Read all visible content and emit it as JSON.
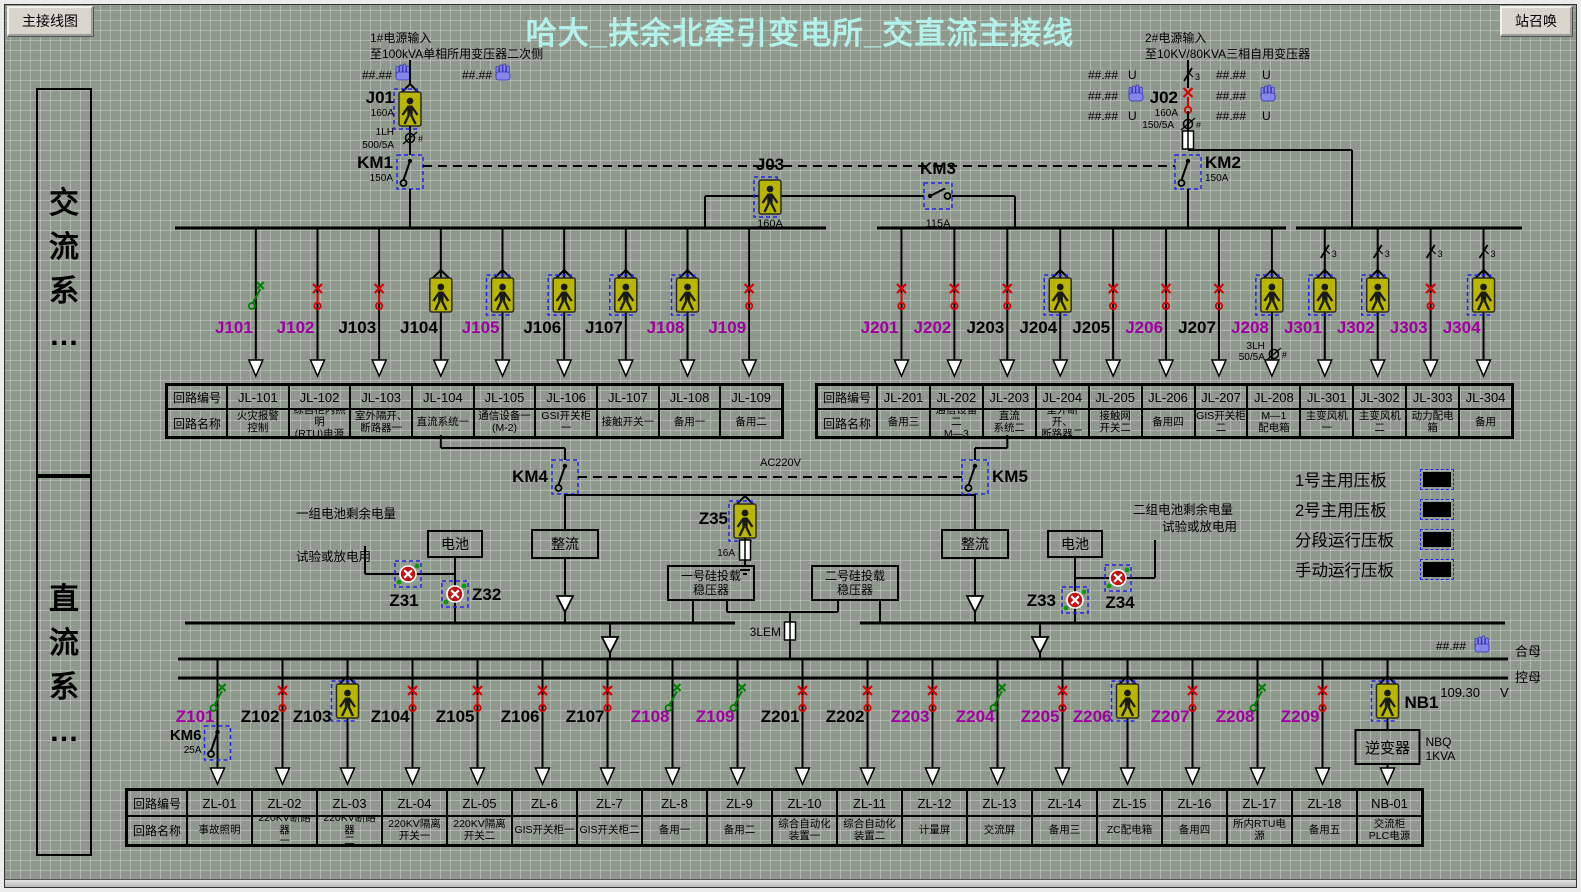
{
  "window": {
    "main_button": "主接线图",
    "call_button": "站召唤",
    "title": "哈大_扶余北牵引变电所_交直流主接线"
  },
  "sidebar": {
    "ac": "交流系…",
    "dc": "直流系…"
  },
  "symbols": {
    "ct_mark": "#"
  },
  "colors": {
    "magenta": "#A000A0",
    "title": "#B2F2EA",
    "yellow": "#B9B600",
    "red": "#D80000",
    "green": "#008000",
    "blue": "#2525E8",
    "bg": "#8F988D"
  },
  "source1": {
    "line1": "1#电源输入",
    "line2": "至100kVA单相所用变压器二次侧",
    "meter_left": "##.##",
    "meter_right": "##.##",
    "breaker": "J01",
    "breaker_rating": "160A",
    "ct_name": "1LH",
    "ct_ratio": "500/5A",
    "contactor": "KM1",
    "contactor_rating": "150A"
  },
  "source2": {
    "line1": "2#电源输入",
    "line2": "至10KV/80KVA三相自用变压器",
    "meters_left": [
      "##.##",
      "##.##",
      "##.##"
    ],
    "meters_right": [
      "##.##",
      "##.##",
      "##.##"
    ],
    "unit": "U",
    "phase": "3",
    "breaker": "J02",
    "breaker_rating": "160A",
    "ct_ratio": "150/5A",
    "contactor": "KM2",
    "contactor_rating": "150A"
  },
  "tie": {
    "breaker": "J03",
    "breaker_rating": "160A",
    "contactor": "KM3",
    "contactor_rating": "115A"
  },
  "ac_left": {
    "feeders": [
      {
        "id": "J101",
        "color": "magenta",
        "symbol": "green-open"
      },
      {
        "id": "J102",
        "color": "magenta",
        "symbol": "red-x"
      },
      {
        "id": "J103",
        "color": "black",
        "symbol": "red-x"
      },
      {
        "id": "J104",
        "color": "black",
        "symbol": "person"
      },
      {
        "id": "J105",
        "color": "magenta",
        "symbol": "person-dash"
      },
      {
        "id": "J106",
        "color": "black",
        "symbol": "person-dash"
      },
      {
        "id": "J107",
        "color": "black",
        "symbol": "person-dash"
      },
      {
        "id": "J108",
        "color": "magenta",
        "symbol": "person-dash"
      },
      {
        "id": "J109",
        "color": "magenta",
        "symbol": "red-x"
      }
    ]
  },
  "ac_right": {
    "feeders": [
      {
        "id": "J201",
        "color": "magenta",
        "symbol": "red-x"
      },
      {
        "id": "J202",
        "color": "magenta",
        "symbol": "red-x"
      },
      {
        "id": "J203",
        "color": "black",
        "symbol": "red-x"
      },
      {
        "id": "J204",
        "color": "black",
        "symbol": "person-dash"
      },
      {
        "id": "J205",
        "color": "black",
        "symbol": "red-x"
      },
      {
        "id": "J206",
        "color": "magenta",
        "symbol": "red-x"
      },
      {
        "id": "J207",
        "color": "black",
        "symbol": "red-x"
      },
      {
        "id": "J208",
        "color": "magenta",
        "symbol": "person-dash",
        "ct_name": "3LH",
        "ct_ratio": "50/5A"
      },
      {
        "id": "J301",
        "color": "magenta",
        "symbol": "person-dash",
        "phase3": true
      },
      {
        "id": "J302",
        "color": "magenta",
        "symbol": "person-dash",
        "phase3": true
      },
      {
        "id": "J303",
        "color": "magenta",
        "symbol": "red-x",
        "phase3": true
      },
      {
        "id": "J304",
        "color": "magenta",
        "symbol": "person-dash",
        "phase3": true
      }
    ]
  },
  "dc_feeders": [
    {
      "id": "Z101",
      "color": "magenta",
      "symbol": "green-open",
      "has_km6": true
    },
    {
      "id": "Z102",
      "color": "black",
      "symbol": "red-x"
    },
    {
      "id": "Z103",
      "color": "black",
      "symbol": "person-dash"
    },
    {
      "id": "Z104",
      "color": "black",
      "symbol": "red-x"
    },
    {
      "id": "Z105",
      "color": "black",
      "symbol": "red-x"
    },
    {
      "id": "Z106",
      "color": "black",
      "symbol": "red-x"
    },
    {
      "id": "Z107",
      "color": "black",
      "symbol": "red-x"
    },
    {
      "id": "Z108",
      "color": "magenta",
      "symbol": "green-open"
    },
    {
      "id": "Z109",
      "color": "magenta",
      "symbol": "green-open"
    },
    {
      "id": "Z201",
      "color": "black",
      "symbol": "red-x"
    },
    {
      "id": "Z202",
      "color": "black",
      "symbol": "red-x"
    },
    {
      "id": "Z203",
      "color": "magenta",
      "symbol": "red-x"
    },
    {
      "id": "Z204",
      "color": "magenta",
      "symbol": "green-open"
    },
    {
      "id": "Z205",
      "color": "magenta",
      "symbol": "red-x"
    },
    {
      "id": "Z206",
      "color": "magenta",
      "symbol": "person-dash"
    },
    {
      "id": "Z207",
      "color": "magenta",
      "symbol": "red-x"
    },
    {
      "id": "Z208",
      "color": "magenta",
      "symbol": "green-open"
    },
    {
      "id": "Z209",
      "color": "magenta",
      "symbol": "red-x"
    },
    {
      "id": "NB1",
      "color": "black",
      "symbol": "person-dash",
      "is_inverter": true
    }
  ],
  "tables": {
    "code_header": "回路编号",
    "name_header": "回路名称",
    "left": [
      {
        "code": "JL-101",
        "name": [
          "火灾报警",
          "控制"
        ]
      },
      {
        "code": "JL-102",
        "name": [
          "综自柜内照明",
          "(RTU)电源"
        ]
      },
      {
        "code": "JL-103",
        "name": [
          "室外隔开、",
          "断路器一"
        ]
      },
      {
        "code": "JL-104",
        "name": [
          "直流系统一"
        ]
      },
      {
        "code": "JL-105",
        "name": [
          "通信设备一",
          "(M-2)"
        ]
      },
      {
        "code": "JL-106",
        "name": [
          "GSI开关柜一"
        ]
      },
      {
        "code": "JL-107",
        "name": [
          "接触开关一"
        ]
      },
      {
        "code": "JL-108",
        "name": [
          "备用一"
        ]
      },
      {
        "code": "JL-109",
        "name": [
          "备用二"
        ]
      }
    ],
    "right": [
      {
        "code": "JL-201",
        "name": [
          "备用三"
        ]
      },
      {
        "code": "JL-202",
        "name": [
          "通信设备二",
          "M—3"
        ]
      },
      {
        "code": "JL-203",
        "name": [
          "直流",
          "系统二"
        ]
      },
      {
        "code": "JL-204",
        "name": [
          "室外断开、",
          "断路器二"
        ]
      },
      {
        "code": "JL-205",
        "name": [
          "接触网",
          "开关二"
        ]
      },
      {
        "code": "JL-206",
        "name": [
          "备用四"
        ]
      },
      {
        "code": "JL-207",
        "name": [
          "GIS开关柜",
          "二"
        ]
      },
      {
        "code": "JL-208",
        "name": [
          "M—1",
          "配电箱"
        ]
      },
      {
        "code": "JL-301",
        "name": [
          "主变风机一"
        ]
      },
      {
        "code": "JL-302",
        "name": [
          "主变风机二"
        ]
      },
      {
        "code": "JL-303",
        "name": [
          "动力配电箱"
        ]
      },
      {
        "code": "JL-304",
        "name": [
          "备用"
        ]
      }
    ],
    "bottom": [
      {
        "code": "ZL-01",
        "name": [
          "事故照明"
        ]
      },
      {
        "code": "ZL-02",
        "name": [
          "220KV断路器",
          "一"
        ]
      },
      {
        "code": "ZL-03",
        "name": [
          "220KV断路器",
          "二"
        ]
      },
      {
        "code": "ZL-04",
        "name": [
          "220KV隔离",
          "开关一"
        ]
      },
      {
        "code": "ZL-05",
        "name": [
          "220KV隔离",
          "开关二"
        ]
      },
      {
        "code": "ZL-6",
        "name": [
          "GIS开关柜一"
        ]
      },
      {
        "code": "ZL-7",
        "name": [
          "GIS开关柜二"
        ]
      },
      {
        "code": "ZL-8",
        "name": [
          "备用一"
        ]
      },
      {
        "code": "ZL-9",
        "name": [
          "备用二"
        ]
      },
      {
        "code": "ZL-10",
        "name": [
          "综合自动化",
          "装置一"
        ]
      },
      {
        "code": "ZL-11",
        "name": [
          "综合自动化",
          "装置二"
        ]
      },
      {
        "code": "ZL-12",
        "name": [
          "计量屏"
        ]
      },
      {
        "code": "ZL-13",
        "name": [
          "交流屏"
        ]
      },
      {
        "code": "ZL-14",
        "name": [
          "备用三"
        ]
      },
      {
        "code": "ZL-15",
        "name": [
          "ZC配电箱"
        ]
      },
      {
        "code": "ZL-16",
        "name": [
          "备用四"
        ]
      },
      {
        "code": "ZL-17",
        "name": [
          "所内RTU电源"
        ]
      },
      {
        "code": "ZL-18",
        "name": [
          "备用五"
        ]
      },
      {
        "code": "NB-01",
        "name": [
          "交流柜",
          "PLC电源"
        ]
      }
    ]
  },
  "dc": {
    "km4": "KM4",
    "km5": "KM5",
    "ac_line": "AC220V",
    "z35": "Z35",
    "z35_fuse": "16A",
    "battery": "电池",
    "rectifier": "整流",
    "bat1_note1": "一组电池剩余电量",
    "bat1_note2": "试验或放电用",
    "bat2_note1": "二组电池剩余电量",
    "bat2_note2": "试验或放电用",
    "z31": "Z31",
    "z32": "Z32",
    "z33": "Z33",
    "z34": "Z34",
    "regulator1": [
      "一号硅投载",
      "稳压器"
    ],
    "regulator2": [
      "二号硅投载",
      "稳压器"
    ],
    "lem": "3LEM"
  },
  "plates": [
    {
      "label": "1号主用压板"
    },
    {
      "label": "2号主用压板"
    },
    {
      "label": "分段运行压板"
    },
    {
      "label": "手动运行压板"
    }
  ],
  "dc_bus": {
    "meter": "##.##",
    "bus1": "合母",
    "bus2": "控母",
    "voltage": "109.30",
    "unit": "V"
  },
  "nb": {
    "inverter": "逆变器",
    "model": "NBQ",
    "rating": "1KVA"
  },
  "km6": {
    "label": "KM6",
    "rating": "25A"
  }
}
